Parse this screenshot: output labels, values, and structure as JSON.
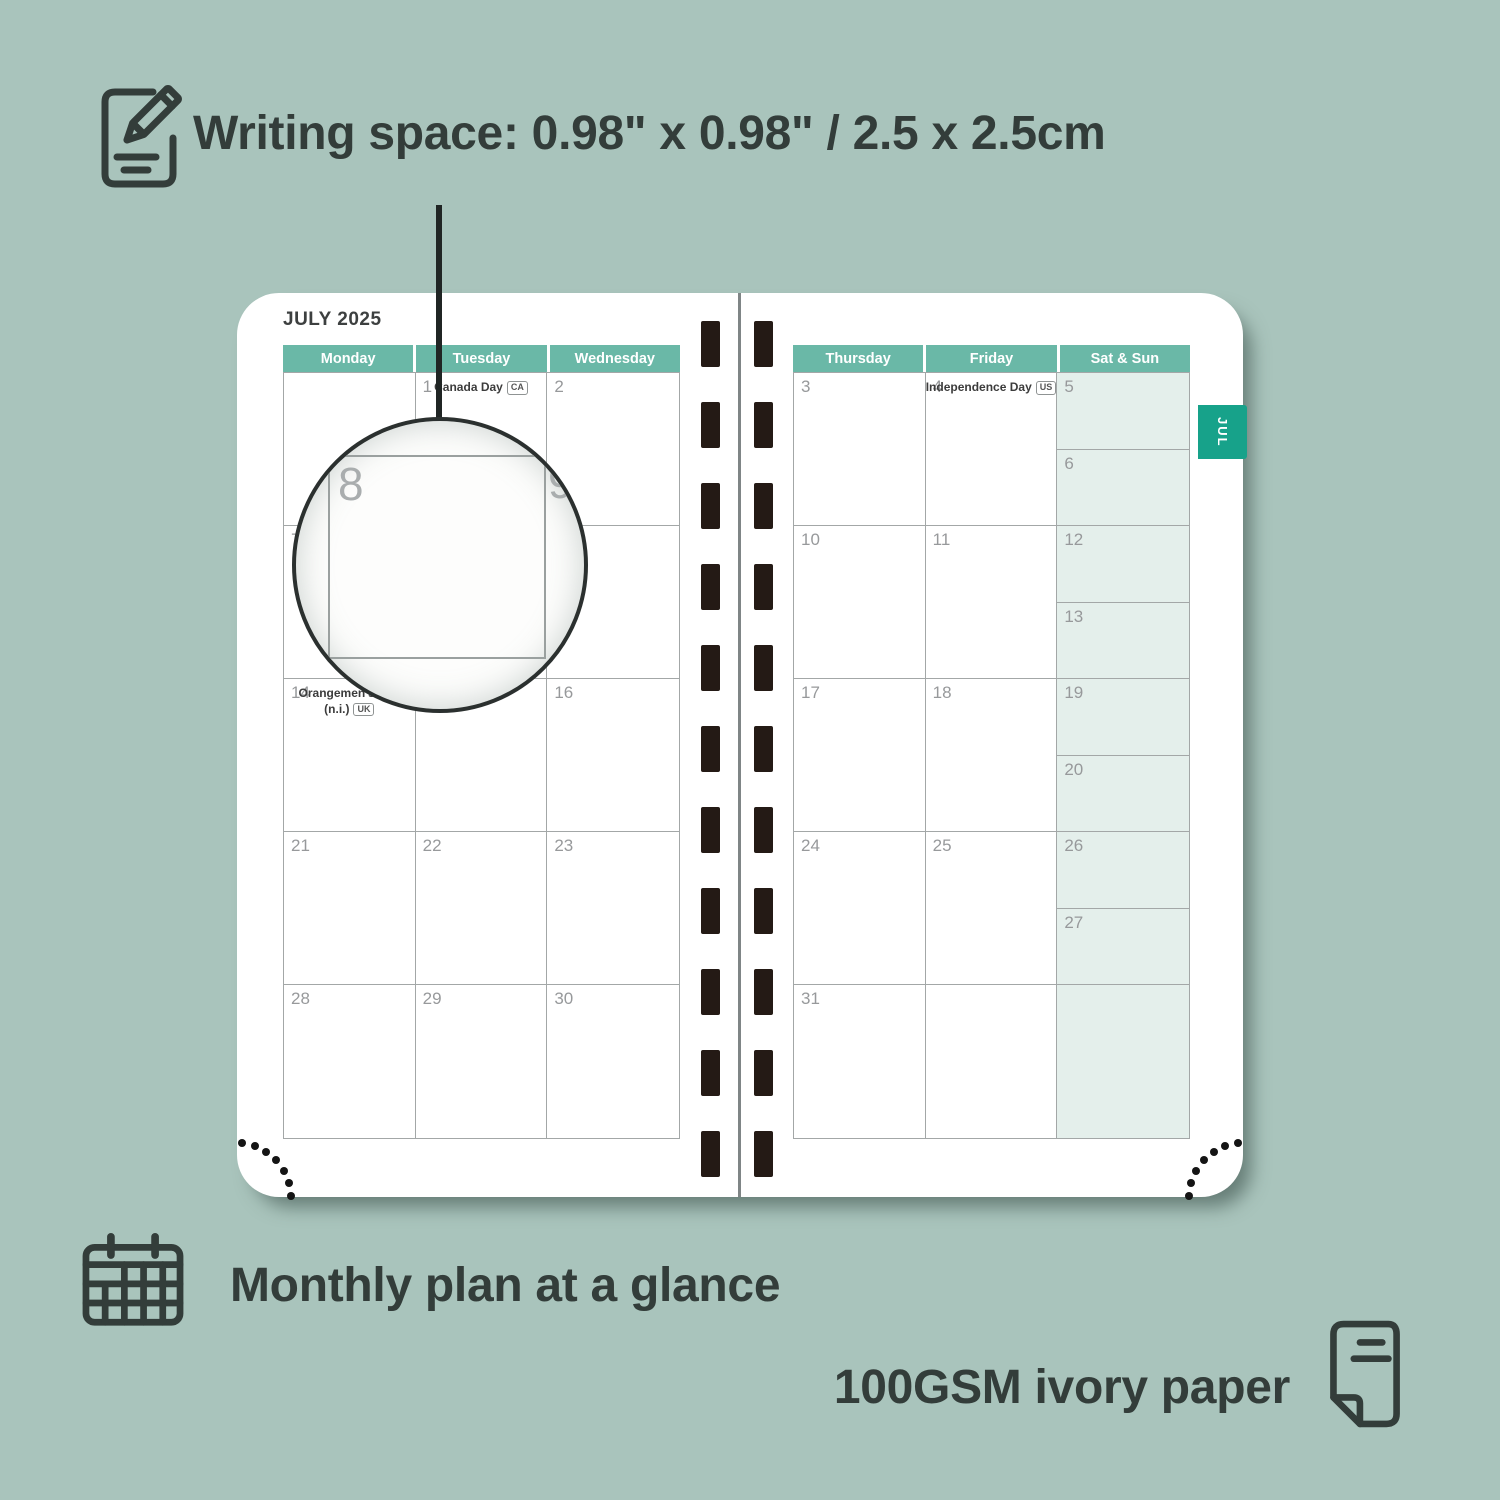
{
  "colors": {
    "background": "#a9c4bc",
    "header_teal": "#6ab8a7",
    "tab_teal": "#17a28a",
    "weekend_fill": "#e4efeb",
    "grid_line": "#a3a7a7",
    "day_number_gray": "#97999b",
    "binding_hole": "#241a15",
    "text_dark": "#333d3a"
  },
  "features": {
    "writing_space_label": "Writing space: 0.98\" x 0.98\" / 2.5 x 2.5cm",
    "monthly_plan_label": "Monthly plan at a glance",
    "paper_label": "100GSM ivory paper"
  },
  "planner": {
    "month_title": "JULY 2025",
    "tab_label": "JUL",
    "magnifier": {
      "day": "8",
      "adjacent_day": "9"
    },
    "left_page": {
      "headers": [
        "Monday",
        "Tuesday",
        "Wednesday"
      ],
      "rows": [
        [
          {
            "day": ""
          },
          {
            "day": "1",
            "holiday_lines": [
              "Canada Day"
            ],
            "badge": "CA"
          },
          {
            "day": "2"
          }
        ],
        [
          {
            "day": "7"
          },
          {
            "day": "8"
          },
          {
            "day": "9"
          }
        ],
        [
          {
            "day": "14",
            "holiday_lines": [
              "Orangemen's Day",
              "(n.i.)"
            ],
            "badge": "UK"
          },
          {
            "day": "15"
          },
          {
            "day": "16"
          }
        ],
        [
          {
            "day": "21"
          },
          {
            "day": "22"
          },
          {
            "day": "23"
          }
        ],
        [
          {
            "day": "28"
          },
          {
            "day": "29"
          },
          {
            "day": "30"
          }
        ]
      ]
    },
    "right_page": {
      "headers": [
        "Thursday",
        "Friday",
        "Sat & Sun"
      ],
      "rows": [
        [
          {
            "day": "3"
          },
          {
            "day": "4",
            "holiday_lines": [
              "Independence Day"
            ],
            "badge": "US"
          },
          {
            "weekend": [
              "5",
              "6"
            ]
          }
        ],
        [
          {
            "day": "10"
          },
          {
            "day": "11"
          },
          {
            "weekend": [
              "12",
              "13"
            ]
          }
        ],
        [
          {
            "day": "17"
          },
          {
            "day": "18"
          },
          {
            "weekend": [
              "19",
              "20"
            ]
          }
        ],
        [
          {
            "day": "24"
          },
          {
            "day": "25"
          },
          {
            "weekend": [
              "26",
              "27"
            ]
          }
        ],
        [
          {
            "day": "31"
          },
          {
            "day": ""
          },
          {
            "weekend_full": true
          }
        ]
      ]
    }
  }
}
